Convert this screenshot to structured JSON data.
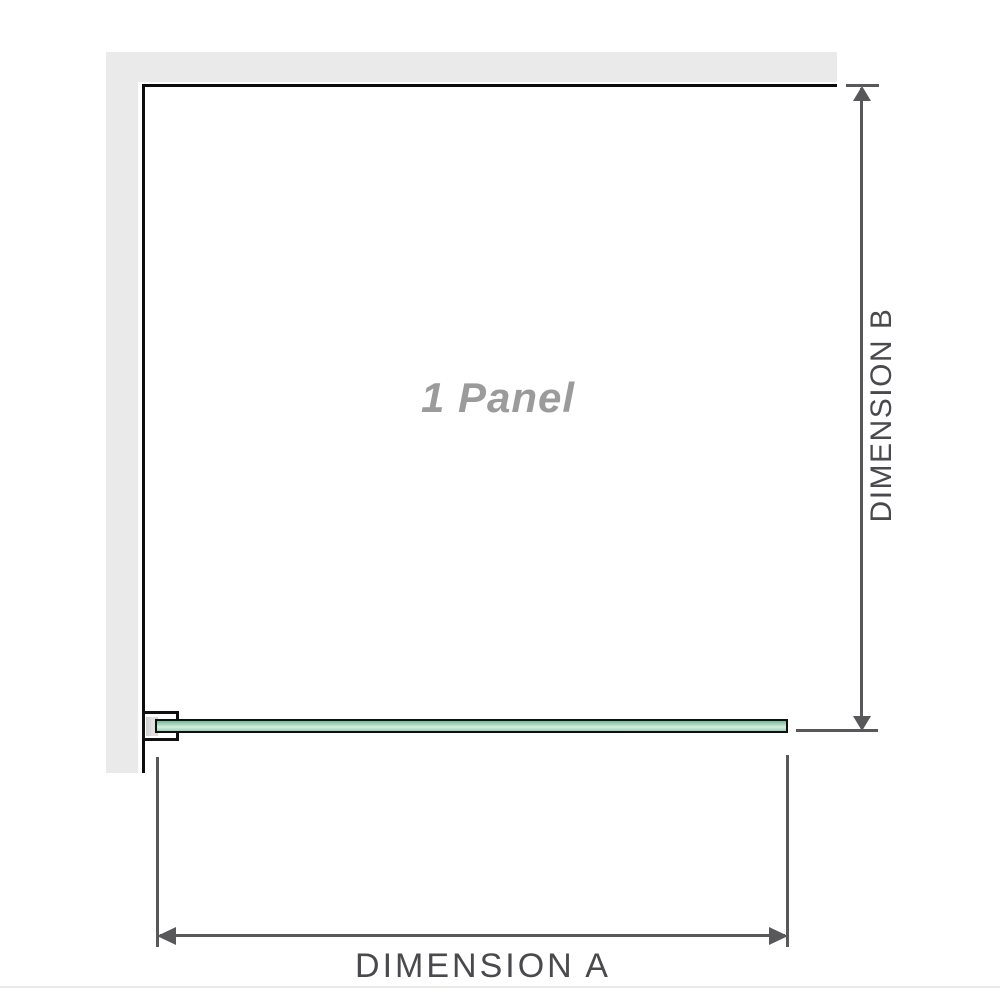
{
  "diagram": {
    "panel_label": "1 Panel",
    "dimension_a": {
      "label": "DIMENSION A"
    },
    "dimension_b": {
      "label": "DIMENSION B"
    }
  },
  "colors": {
    "wall": "#eaeaea",
    "panel_outline": "#0c0c0c",
    "dimension_lines": "#58585b",
    "dimension_text": "#4a4a4e",
    "panel_label_text": "#9b9b9b",
    "glass_green_dark": "#79b899",
    "glass_green_mid": "#a6d8bc",
    "glass_green_highlight": "#d6eee1",
    "bracket_fill": "#d6d6d6",
    "divider": "#e9e9e5"
  }
}
